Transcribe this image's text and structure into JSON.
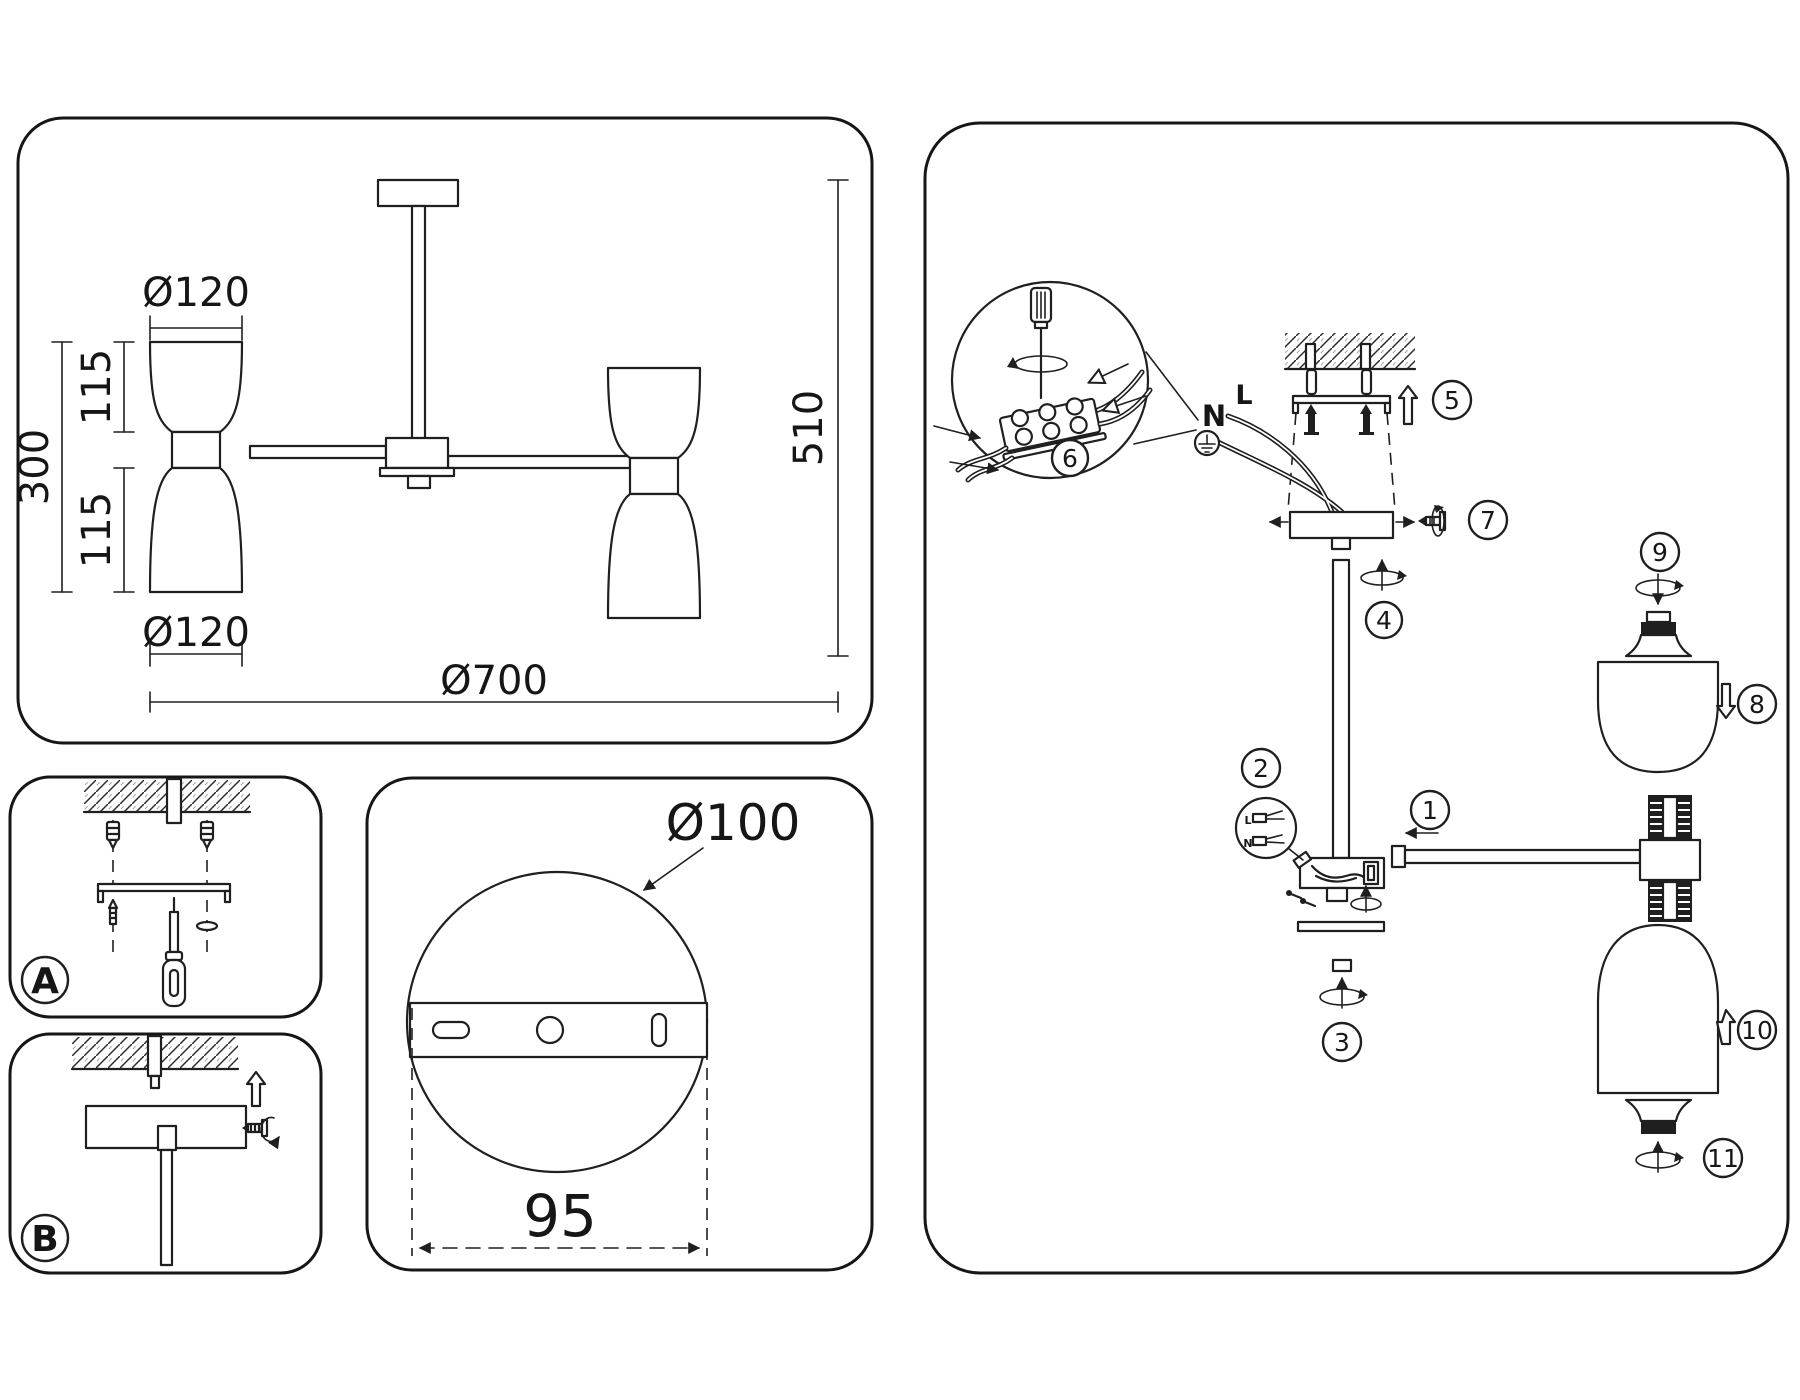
{
  "colors": {
    "background": "#ffffff",
    "line": "#1f1f1f"
  },
  "spec_panel": {
    "dims": {
      "top_shade_diameter": "Ø120",
      "upper_shade_height": "115",
      "body_height": "300",
      "lower_shade_height": "115",
      "bottom_shade_diameter": "Ø120",
      "fixture_diameter": "Ø700",
      "fixture_height": "510"
    }
  },
  "step_panels": {
    "a_label": "A",
    "b_label": "B"
  },
  "template_panel": {
    "plate_diameter": "Ø100",
    "hole_spacing": "95"
  },
  "assembly_panel": {
    "wire_neutral": "N",
    "wire_live": "L",
    "steps": [
      "1",
      "2",
      "3",
      "4",
      "5",
      "6",
      "7",
      "8",
      "9",
      "10",
      "11"
    ]
  }
}
